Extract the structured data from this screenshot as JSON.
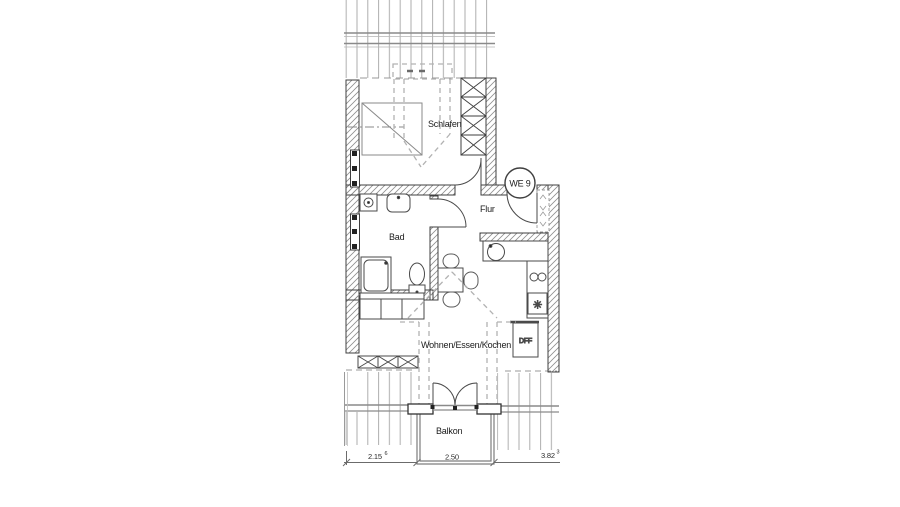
{
  "plan": {
    "unit_badge": "WE 9",
    "labels": {
      "bedroom": "Schlafen",
      "hall": "Flur",
      "bath": "Bad",
      "living": "Wohnen/Essen/Kochen",
      "balcony": "Balkon",
      "roof_window": "DFF"
    },
    "symbols": {
      "fridge": "✳"
    },
    "dimensions": {
      "left": {
        "main": "2.15",
        "sup": "6"
      },
      "balcony": {
        "main": "2.50"
      },
      "right": {
        "main": "3.82",
        "sup": "3"
      }
    },
    "colors": {
      "line": "#3f3f3f",
      "roof_hatch": "#aeaeae",
      "wall_hatch": "#8f8f8f",
      "dashed": "#b2b2b2",
      "text": "#1c1c1c"
    }
  }
}
